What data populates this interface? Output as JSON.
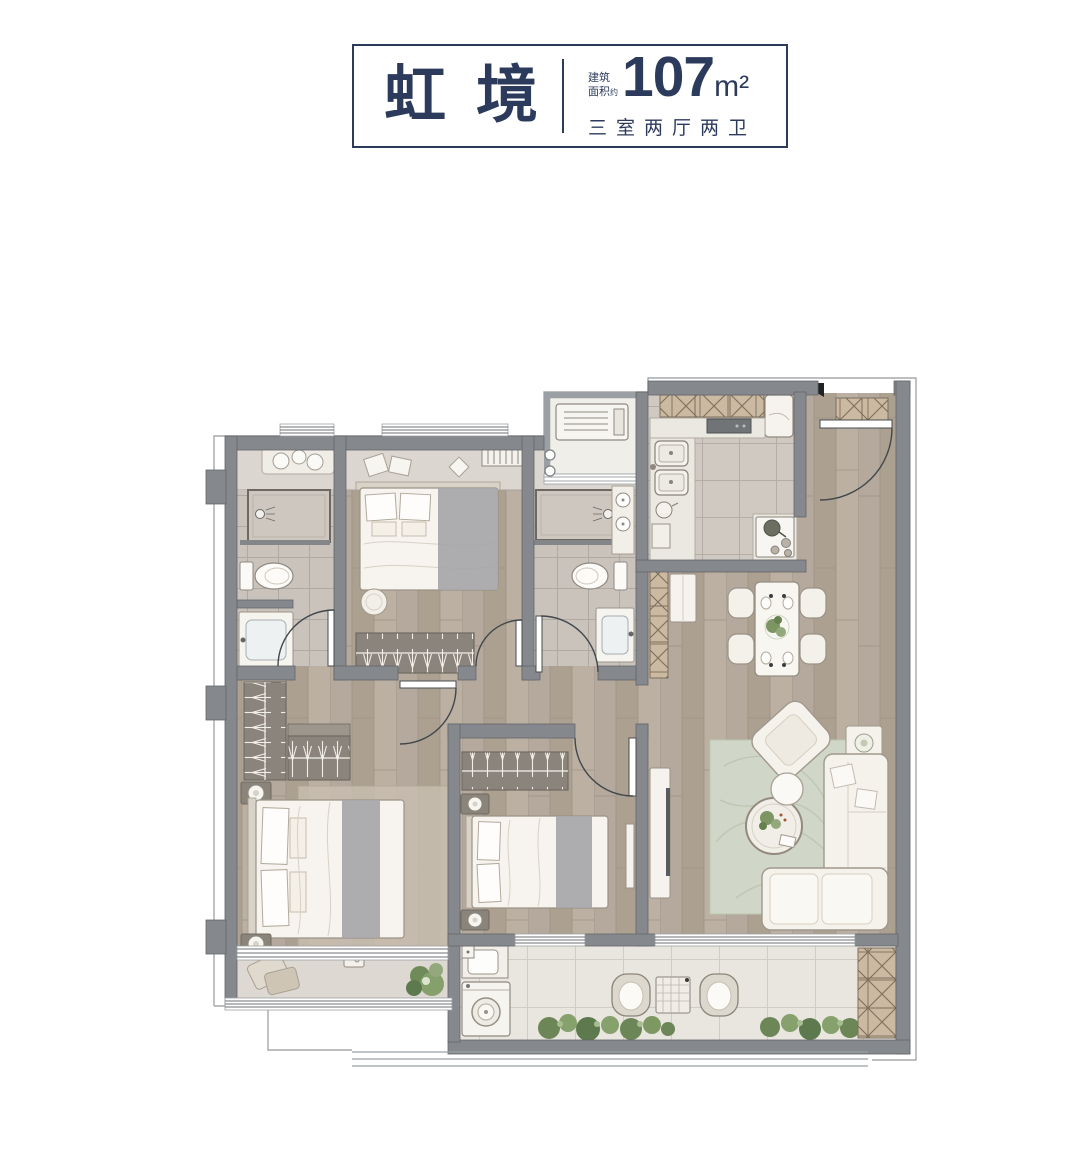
{
  "title_block": {
    "project_name": "虹境",
    "area_label_line1": "建筑",
    "area_label_line2": "面积",
    "area_label_approx": "约",
    "area_value": "107",
    "area_unit": "m²",
    "layout_text": "三室两厅两卫"
  },
  "colors": {
    "accent_navy": "#2c3b5c",
    "wall_gray": "#85888c",
    "wood_floor": "#b2a79a",
    "bath_tile": "#c9c3bc",
    "balcony_tile": "#e9e6df",
    "marble_sill": "#dbd6cf",
    "cabinet_hatch_tan": "#cbb9a2",
    "rug_sage": "#d0d6c8",
    "plant_green": "#7d9562",
    "furniture_white": "#f5f2ec",
    "blanket_gray": "#a6a6aa"
  }
}
